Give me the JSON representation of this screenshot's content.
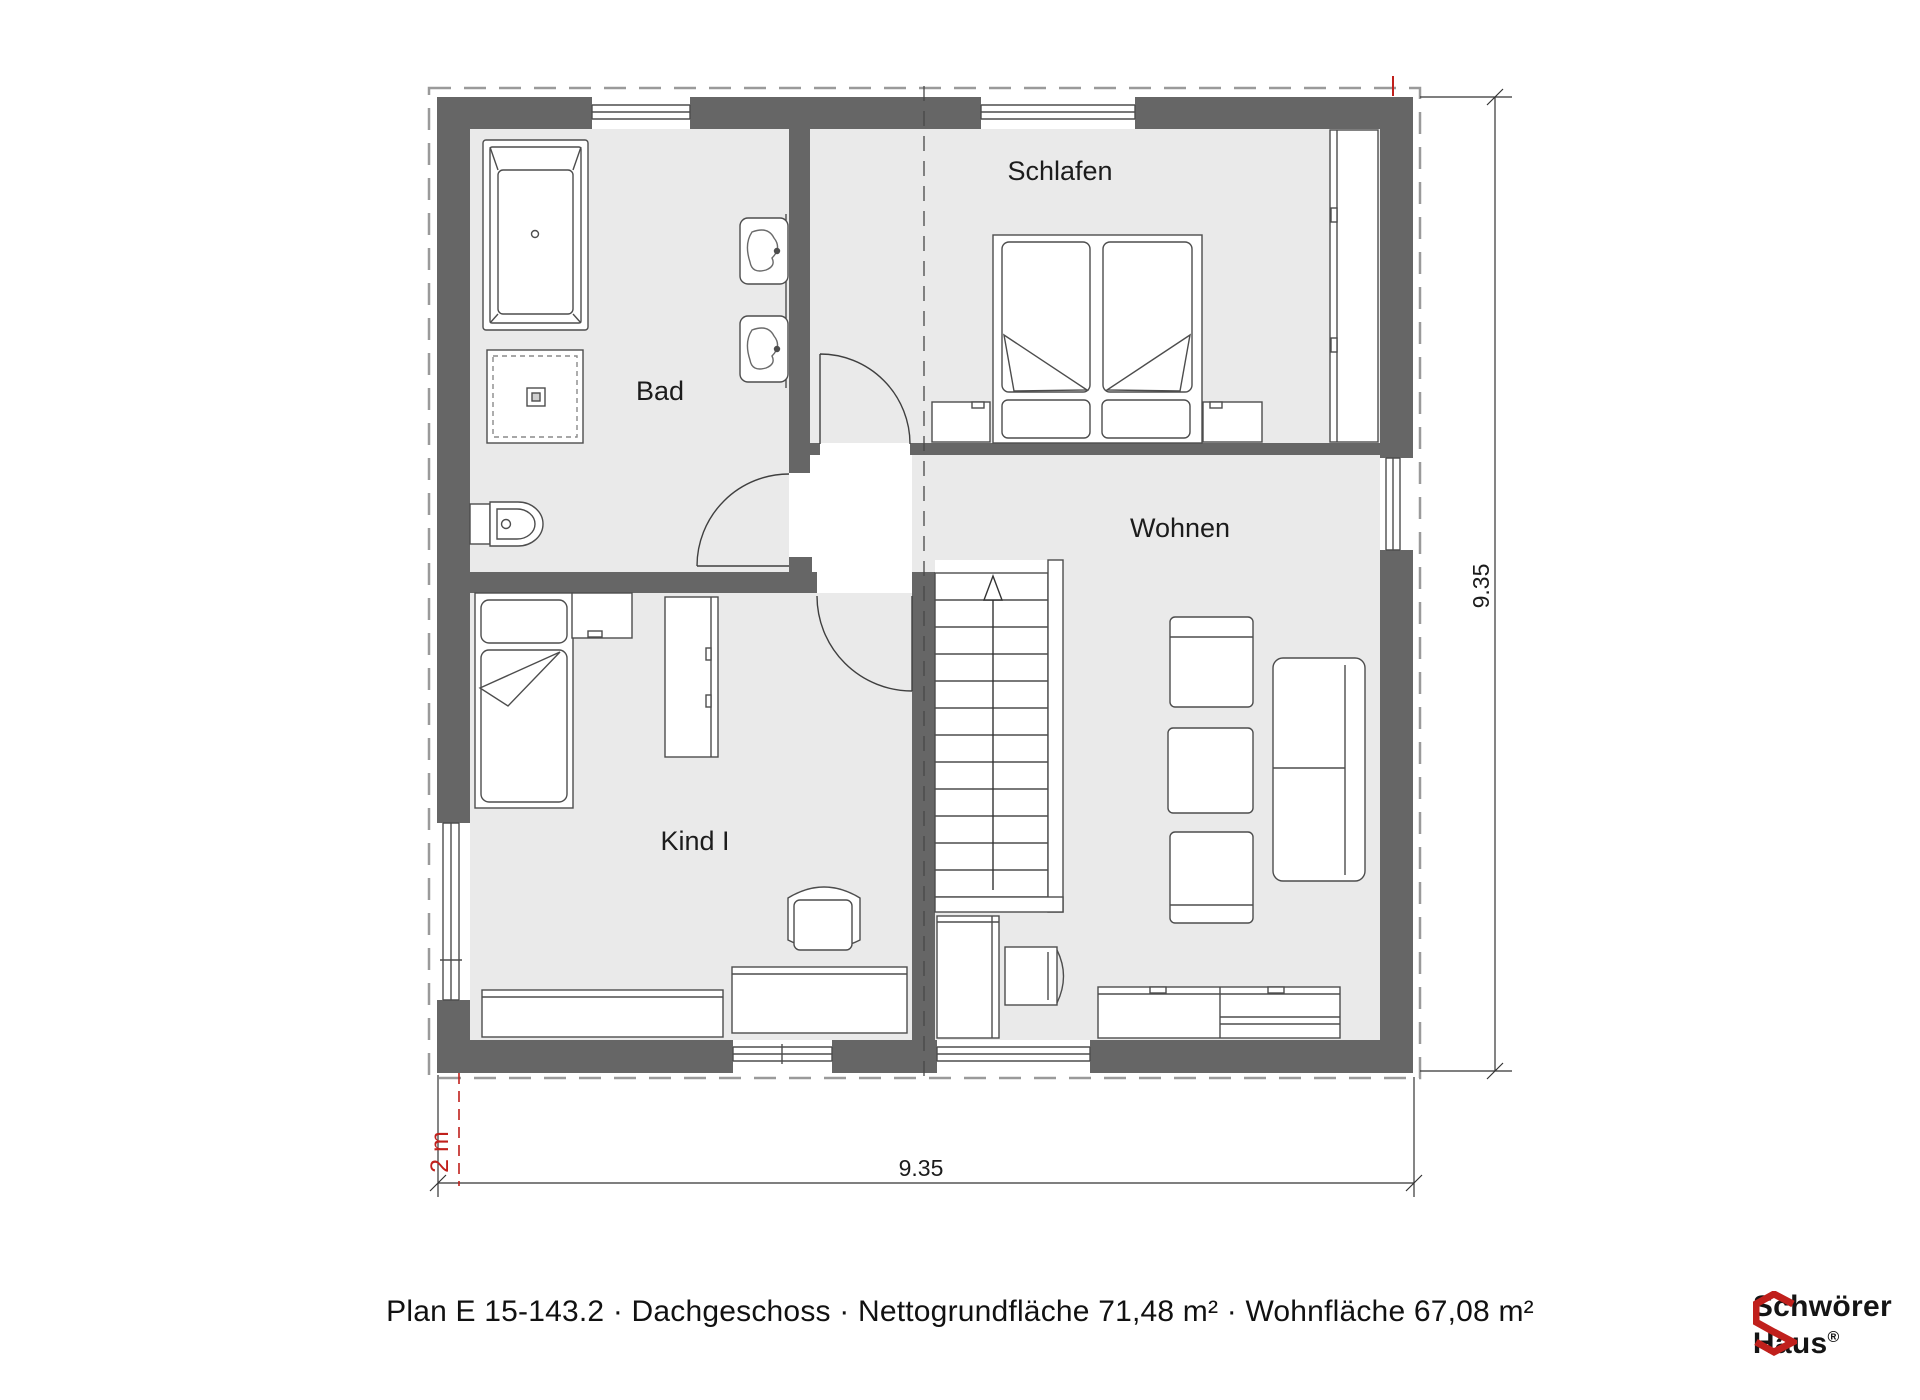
{
  "plan": {
    "rooms": {
      "bad": "Bad",
      "schlafen": "Schlafen",
      "wohnen": "Wohnen",
      "kind1": "Kind I"
    },
    "dimensions": {
      "width_label": "9.35",
      "height_label": "9.35",
      "red_height_label": "2 m"
    }
  },
  "footer": {
    "text": "Plan E 15-143.2 · Dachgeschoss · Nettogrundfläche 71,48 m² · Wohnfläche 67,08 m²"
  },
  "logo": {
    "line1": "Schwörer",
    "line2": "Haus",
    "registered": "®"
  },
  "colors": {
    "wall": "#666666",
    "floor": "#eaeaea",
    "accent_red": "#c0201c"
  }
}
